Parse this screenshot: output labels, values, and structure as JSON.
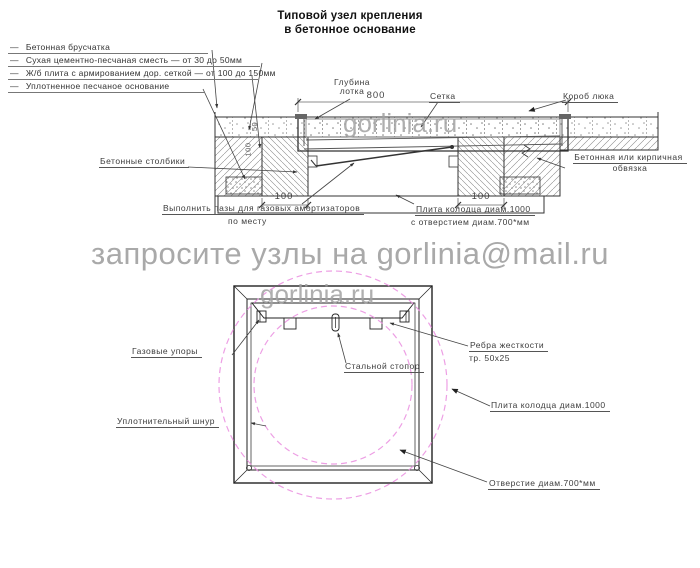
{
  "title": {
    "line1": "Типовой узел крепления",
    "line2": "в бетонное основание"
  },
  "legend": {
    "bullet": "—",
    "items": [
      "Бетонная брусчатка",
      "Сухая цементно-песчаная сместь — от 30 до 50мм",
      "Ж/б плита с армированием дор. сеткой — от 100 до 150мм",
      "Уплотненное песчаное основание"
    ]
  },
  "watermarks": {
    "banner": "запросите узлы на gorlinia@mail.ru",
    "site": "gorlinia.ru",
    "color": "#a2a2a2"
  },
  "section": {
    "dims": {
      "tray_width": "800",
      "left_column": "100",
      "right_column": "100",
      "paving_depth": "50",
      "slab_depth": "100"
    },
    "labels": {
      "tray_depth_1": "Глубина",
      "tray_depth_2": "лотка",
      "mesh": "Сетка",
      "hatch_box": "Короб люка",
      "posts": "Бетонные столбики",
      "binding_1": "Бетонная или кирпичная",
      "binding_2": "обвязка",
      "grooves_1": "Выполнить пазы для газовых амортизаторов",
      "grooves_2": "по месту",
      "slab_1": "Плита колодца диам.1000",
      "slab_2": "с отверстием диам.700*мм"
    }
  },
  "plan": {
    "circle_color": "#ea8fe0",
    "labels": {
      "gas_struts": "Газовые упоры",
      "steel_stopper": "Стальной стопор",
      "ribs_1": "Ребра жесткости",
      "ribs_2": "тр. 50х25",
      "slab": "Плита колодца диам.1000",
      "seal_cord": "Уплотнительный шнур",
      "opening": "Отверстие диам.700*мм"
    }
  }
}
